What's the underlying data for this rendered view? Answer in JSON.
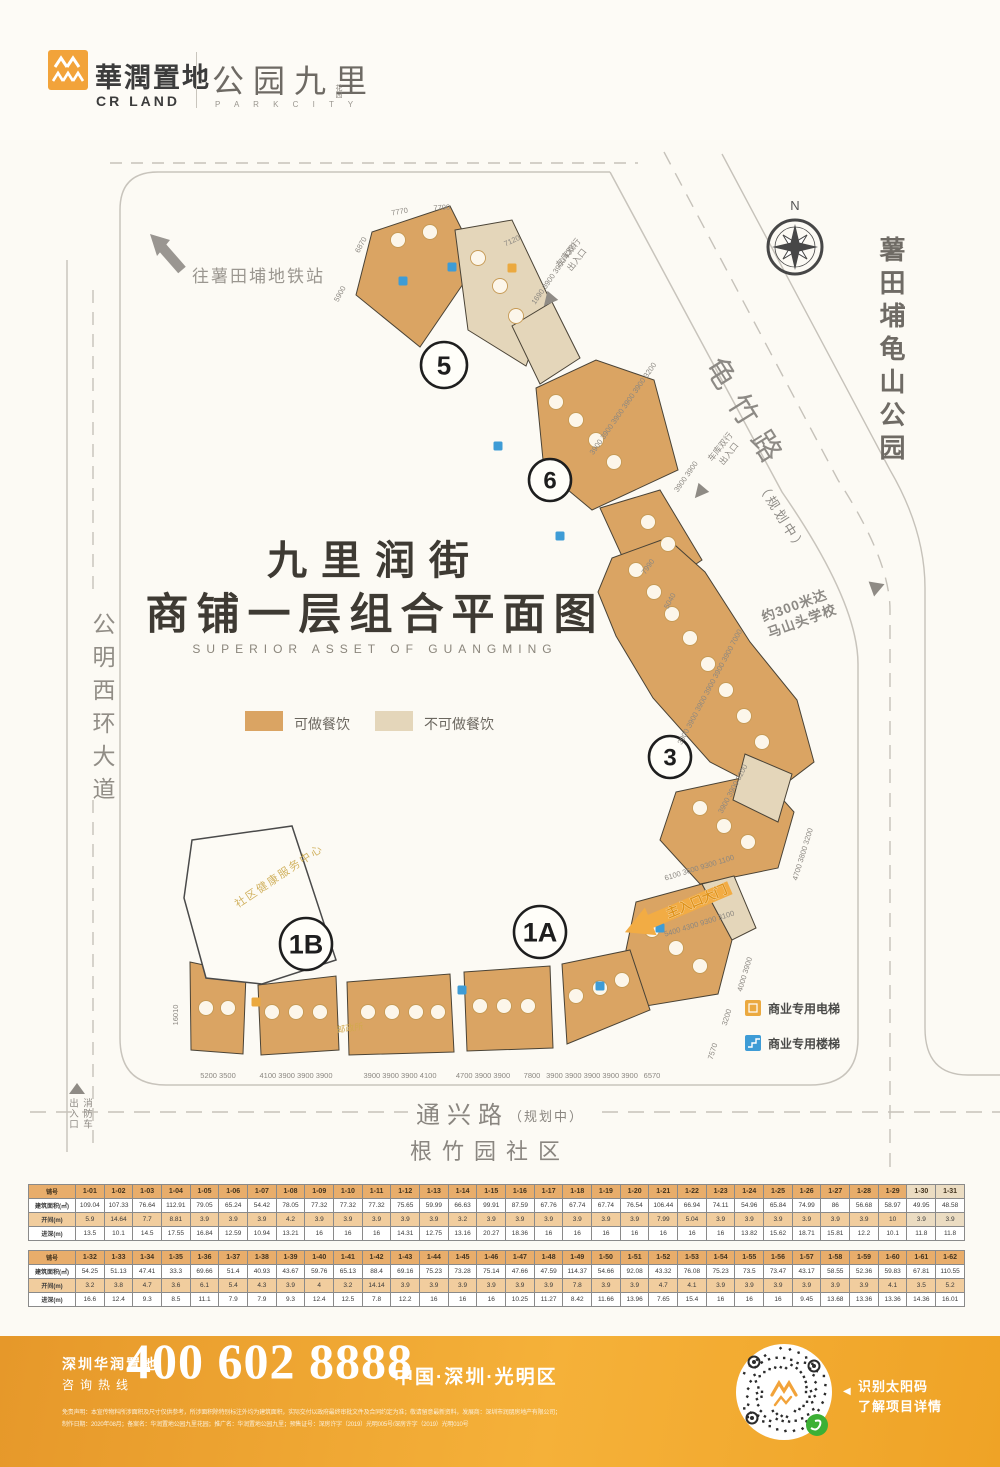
{
  "header": {
    "logo_cn": "華潤置地",
    "logo_en": "CR LAND",
    "project_cn": "公园九里",
    "project_suffix": "花园",
    "project_en": "P A R K C I T Y"
  },
  "plan": {
    "title_line1": "九里润街",
    "title_line2": "商铺一层组合平面图",
    "title_en": "SUPERIOR ASSET OF GUANGMING",
    "legend": {
      "catering": "可做餐饮",
      "no_catering": "不可做餐饮"
    },
    "legend2": {
      "elevator": "商业专用电梯",
      "stairs": "商业专用楼梯"
    },
    "labels": {
      "north": "N",
      "subway": "往薯田埔地铁站",
      "park": "薯田埔龟山公园",
      "road_right": "龟竹路",
      "road_right_note": "（规划中）",
      "road_left": "公明西环大道",
      "road_bottom": "通兴路",
      "road_bottom_note": "（规划中）",
      "community": "根竹园社区",
      "school_line1": "约300米达",
      "school_line2": "马山头学校",
      "garage_line1": "车库双行",
      "garage_line2": "出入口",
      "main_gate": "主入口大门",
      "fire_line1": "消防车",
      "fire_line2": "出入口",
      "health_center": "社区健康服务中心",
      "post_office": "邮政所"
    },
    "zones": [
      "5",
      "6",
      "3",
      "1A",
      "1B"
    ],
    "dimensions": [
      "7770",
      "7700",
      "6870",
      "5900",
      "7120",
      "1690 3900 3900 4200",
      "3900 3900 3900 3900 3900 3200",
      "3900 3900",
      "7990",
      "5040",
      "3900 3900 3900 3900 3900 3900 7000",
      "3900 3900 3200",
      "6100  3600  9300  1100",
      "4700 3800 3200",
      "5400  4300  9300  3100",
      "4000 3900",
      "3200",
      "7570",
      "16010",
      "5200 3500",
      "4100 3900 3900 3900",
      "3900 3900 3900 4100",
      "4700 3900 3900",
      "7800",
      "3900 3900 3900 3900 3900",
      "6570"
    ]
  },
  "tables": [
    {
      "row_labels": {
        "shop": "铺号",
        "area": "建筑面积(㎡)",
        "width": "开间(m)",
        "depth": "进深(m)"
      },
      "shops": [
        "1-01",
        "1-02",
        "1-03",
        "1-04",
        "1-05",
        "1-06",
        "1-07",
        "1-08",
        "1-09",
        "1-10",
        "1-11",
        "1-12",
        "1-13",
        "1-14",
        "1-15",
        "1-16",
        "1-17",
        "1-18",
        "1-19",
        "1-20",
        "1-21",
        "1-22",
        "1-23",
        "1-24",
        "1-25",
        "1-26",
        "1-27",
        "1-28",
        "1-29",
        "1-30",
        "1-31"
      ],
      "areas": [
        "109.04",
        "107.33",
        "76.64",
        "112.91",
        "79.05",
        "65.24",
        "54.42",
        "78.05",
        "77.32",
        "77.32",
        "77.32",
        "75.65",
        "59.99",
        "66.63",
        "99.91",
        "87.59",
        "67.76",
        "67.74",
        "67.74",
        "76.54",
        "106.44",
        "66.94",
        "74.11",
        "54.96",
        "65.84",
        "74.99",
        "86",
        "56.68",
        "58.97",
        "49.95",
        "48.58"
      ],
      "widths": [
        "5.9",
        "14.64",
        "7.7",
        "8.81",
        "3.9",
        "3.9",
        "3.9",
        "4.2",
        "3.9",
        "3.9",
        "3.9",
        "3.9",
        "3.9",
        "3.2",
        "3.9",
        "3.9",
        "3.9",
        "3.9",
        "3.9",
        "3.9",
        "7.99",
        "5.04",
        "3.9",
        "3.9",
        "3.9",
        "3.9",
        "3.9",
        "3.9",
        "10",
        "3.9",
        "3.9"
      ],
      "depths": [
        "13.5",
        "10.1",
        "14.5",
        "17.55",
        "16.84",
        "12.59",
        "10.94",
        "13.21",
        "16",
        "16",
        "16",
        "14.31",
        "12.75",
        "13.16",
        "20.27",
        "18.36",
        "16",
        "16",
        "16",
        "16",
        "16",
        "16",
        "16",
        "13.82",
        "15.62",
        "18.71",
        "15.81",
        "12.2",
        "10.1",
        "11.8",
        "11.8"
      ],
      "light_cols": [
        29,
        30
      ]
    },
    {
      "row_labels": {
        "shop": "铺号",
        "area": "建筑面积(㎡)",
        "width": "开间(m)",
        "depth": "进深(m)"
      },
      "shops": [
        "1-32",
        "1-33",
        "1-34",
        "1-35",
        "1-36",
        "1-37",
        "1-38",
        "1-39",
        "1-40",
        "1-41",
        "1-42",
        "1-43",
        "1-44",
        "1-45",
        "1-46",
        "1-47",
        "1-48",
        "1-49",
        "1-50",
        "1-51",
        "1-52",
        "1-53",
        "1-54",
        "1-55",
        "1-56",
        "1-57",
        "1-58",
        "1-59",
        "1-60",
        "1-61",
        "1-62"
      ],
      "areas": [
        "54.25",
        "51.13",
        "47.41",
        "33.3",
        "69.66",
        "51.4",
        "40.93",
        "43.67",
        "59.76",
        "65.13",
        "88.4",
        "69.16",
        "75.23",
        "73.28",
        "75.14",
        "47.66",
        "47.59",
        "114.37",
        "54.66",
        "92.08",
        "43.32",
        "76.08",
        "75.23",
        "73.5",
        "73.47",
        "43.17",
        "58.55",
        "52.36",
        "59.83",
        "67.81",
        "110.55"
      ],
      "widths": [
        "3.2",
        "3.8",
        "4.7",
        "3.6",
        "6.1",
        "5.4",
        "4.3",
        "3.9",
        "4",
        "3.2",
        "14.14",
        "3.9",
        "3.9",
        "3.9",
        "3.9",
        "3.9",
        "3.9",
        "7.8",
        "3.9",
        "3.9",
        "4.7",
        "4.1",
        "3.9",
        "3.9",
        "3.9",
        "3.9",
        "3.9",
        "3.9",
        "4.1",
        "3.5",
        "5.2"
      ],
      "depths": [
        "16.6",
        "12.4",
        "9.3",
        "8.5",
        "11.1",
        "7.9",
        "7.9",
        "9.3",
        "12.4",
        "12.5",
        "7.8",
        "12.2",
        "16",
        "16",
        "16",
        "10.25",
        "11.27",
        "8.42",
        "11.66",
        "13.96",
        "7.65",
        "15.4",
        "16",
        "16",
        "16",
        "9.45",
        "13.68",
        "13.36",
        "13.36",
        "14.36",
        "16.01"
      ],
      "light_cols": []
    }
  ],
  "footer": {
    "company_line1": "深圳华润置地",
    "company_line2": "咨询热线",
    "phone": "400 602 8888",
    "location": "中国·深圳·光明区",
    "qr_tip1": "识别太阳码",
    "qr_tip2": "了解项目详情",
    "arrow": "◀",
    "disclaimer1": "免责声明：本宣传物料所涉面积及尺寸仅供参考，所涉面积除特别标注外均为建筑面积，实际交付以政府最终审批文件及合同约定为准；敬请留意最新资料，发展商：深圳市润朋房地产有限公司；",
    "disclaimer2": "制作日期：2020年08月；备案名：华润置地公园九里花园；推广名：华润置地公园九里；预售证号：深房许字（2019）光明005号/深房许字（2019）光明010号"
  },
  "colors": {
    "catering": "#DAA463",
    "no_catering": "#E4D6BA",
    "brand_orange": "#F2A33A",
    "elevator_icon": "#EBA93F",
    "stairs_icon": "#3E9CD6"
  }
}
